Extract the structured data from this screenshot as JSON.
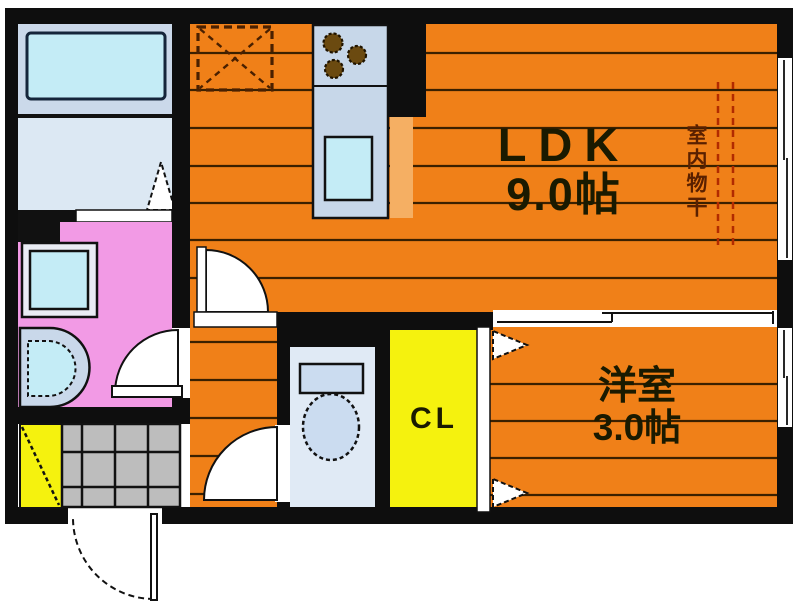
{
  "floorplan": {
    "labels": {
      "ldk_name": "LDK",
      "ldk_area": "9.0帖",
      "western_name": "洋室",
      "western_area": "3.0帖",
      "closet": "CL",
      "indoor_drying": "室内物干"
    },
    "colors": {
      "floor_orange": "#F08018",
      "floor_line": "#3A2000",
      "wall": "#0E0E0E",
      "pink_room": "#F29AE5",
      "closet_yellow": "#F5F20E",
      "bath_bg": "#CBD9EA",
      "tub_cyan": "#C4ECF6",
      "washroom_bg": "#DCE8F3",
      "toilet_bg": "#E0EAF5",
      "fixture_blue": "#CBDCF0",
      "counter_blue": "#C7D7E9",
      "counter_orange": "#F5AF63",
      "tile_grey": "#BDBDBD",
      "washer_ring": "#EAECF4",
      "basin_ring": "#C9D8EA",
      "burner_brown": "#6B4A10",
      "drying_red": "#B22A00",
      "fridge_dash": "#4A2000"
    }
  }
}
